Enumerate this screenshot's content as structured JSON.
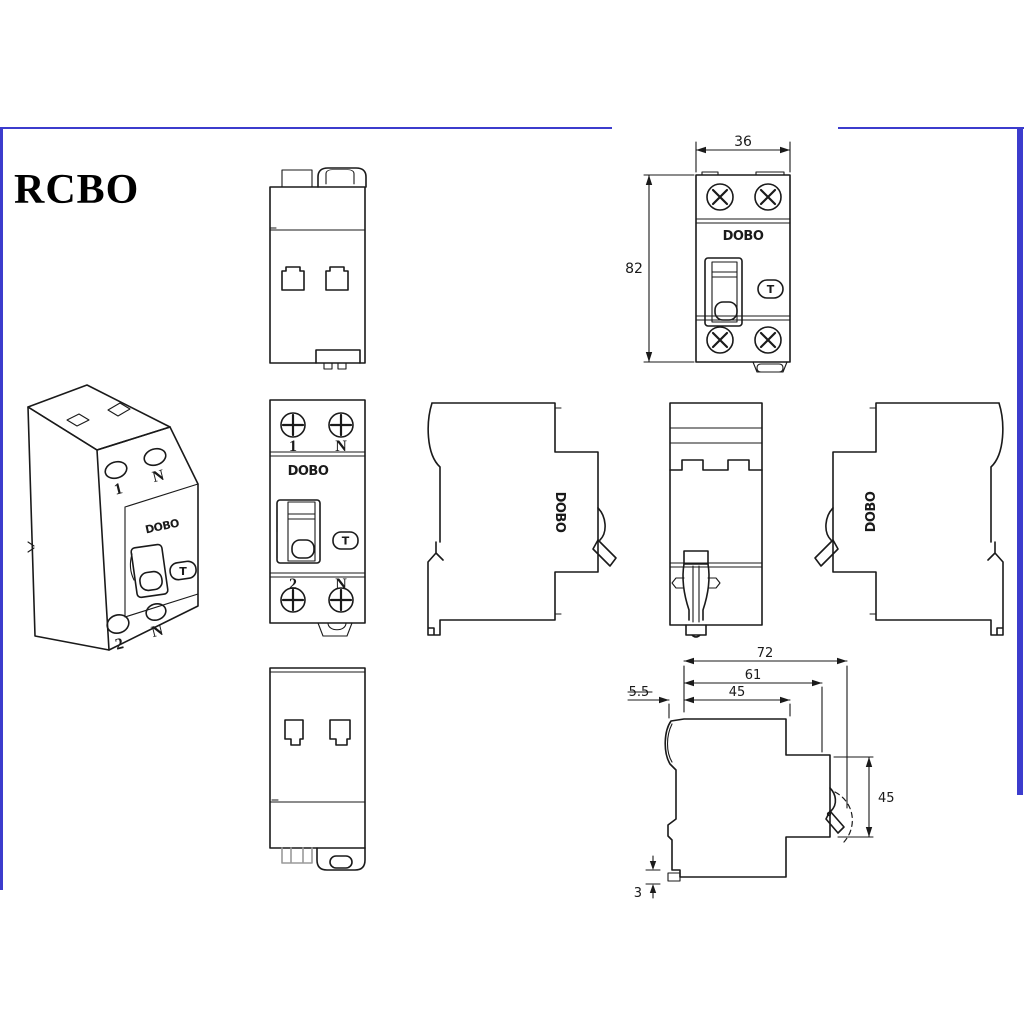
{
  "page": {
    "title": "RCBO"
  },
  "theme": {
    "border_color": "#3c3ccd",
    "line_color": "#1a1a1a"
  },
  "product": {
    "brand": "DOBO",
    "test_button_label": "T"
  },
  "terminals": {
    "top_left": "1",
    "top_right": "N",
    "bottom_left": "2",
    "bottom_right": "N"
  },
  "dimensions": {
    "front_width": "36",
    "front_height": "82",
    "side_total_depth": "72",
    "side_body_depth": "61",
    "side_front_depth": "45",
    "side_rail_offset": "5.5",
    "side_front_height": "45",
    "side_clip_extension": "3"
  }
}
